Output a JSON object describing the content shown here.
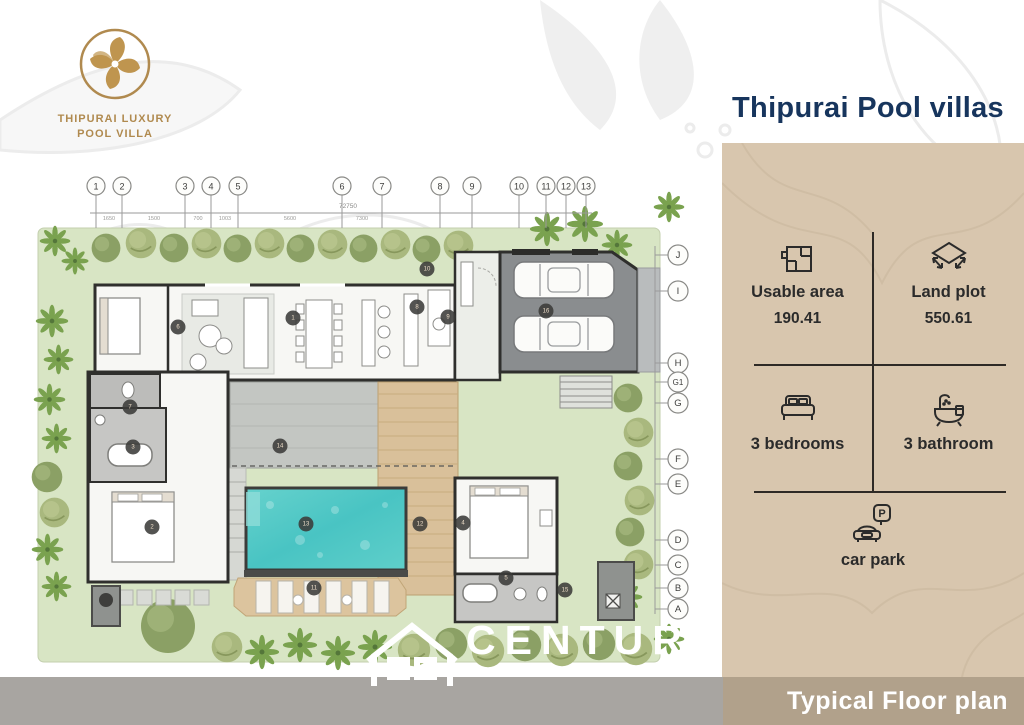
{
  "logo": {
    "line1": "THIPURAI LUXURY",
    "line2": "POOL VILLA"
  },
  "header": {
    "title": "Thipurai Pool villas"
  },
  "panel": {
    "specs": [
      {
        "id": "usable-area",
        "label": "Usable area",
        "value": "190.41"
      },
      {
        "id": "land-plot",
        "label": "Land plot",
        "value": "550.61"
      },
      {
        "id": "bedrooms",
        "label": "3 bedrooms"
      },
      {
        "id": "bathrooms",
        "label": "3 bathroom"
      },
      {
        "id": "car-park",
        "label": "car park"
      }
    ],
    "parking_letter": "P"
  },
  "footer": {
    "label": "Typical Floor plan"
  },
  "watermark": {
    "brand": "CENTURY",
    "subtitle": "PRO REAL ESTATE  HUA HIN"
  },
  "floorplan": {
    "grid_columns": [
      "1",
      "2",
      "3",
      "4",
      "5",
      "6",
      "7",
      "8",
      "9",
      "10",
      "11",
      "12",
      "13"
    ],
    "grid_rows": [
      "J",
      "I",
      "H",
      "G1",
      "G",
      "F",
      "E",
      "D",
      "C",
      "B",
      "A"
    ],
    "room_markers": [
      "1",
      "2",
      "3",
      "4",
      "5",
      "6",
      "7",
      "8",
      "9",
      "10",
      "11",
      "12",
      "13",
      "14",
      "15",
      "16"
    ],
    "dimensions": {
      "total": "72750",
      "segments": [
        "1650",
        "1500",
        "700",
        "1003",
        "5600",
        "7300"
      ]
    },
    "colors": {
      "pool": "#4fc7c5",
      "deck": "#d9c09a",
      "lawn": "#d8e5c4",
      "garage": "#8a8d8f",
      "road": "#a8a5a1",
      "panel": "#d8c6ae",
      "bar": "#b1a18b",
      "navy": "#17355d",
      "gold": "#b08a4f"
    }
  }
}
